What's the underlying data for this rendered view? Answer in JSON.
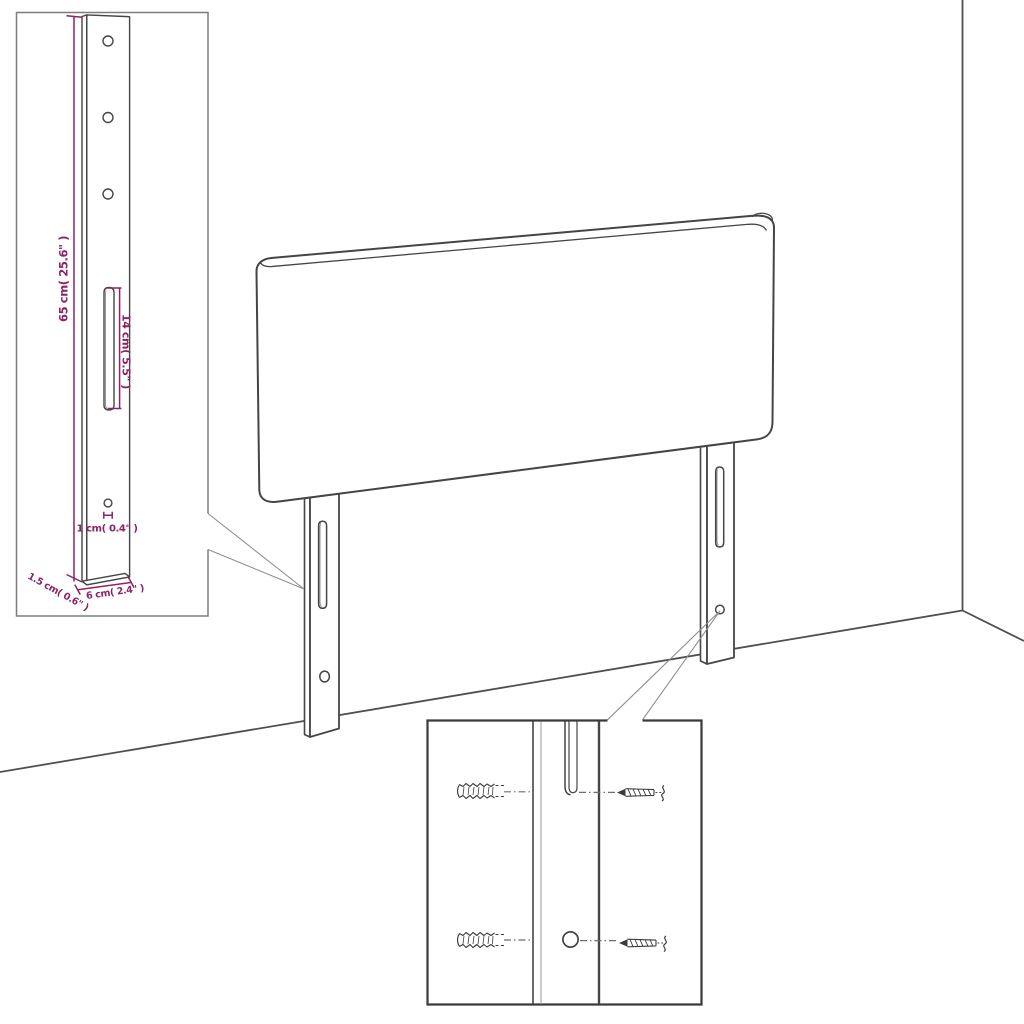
{
  "title": "Headboard assembly and dimensions diagram",
  "colors": {
    "line": "#454545",
    "wall": "#4f4f4f",
    "dimension": "#8b2365",
    "pointer": "#8f8f8f",
    "inset_border": "#7d7d7d",
    "detail_border": "#3a3a3a",
    "light_line": "#9a9a9a",
    "background": "#ffffff"
  },
  "dimensions": {
    "height": "65 cm( 25.6\" )",
    "slot": "14 cm( 5.5\" )",
    "hole": "1 cm( 0.4\" )",
    "depth": "1.5 cm( 0.6\" )",
    "width": "6 cm( 2.4\" )"
  }
}
